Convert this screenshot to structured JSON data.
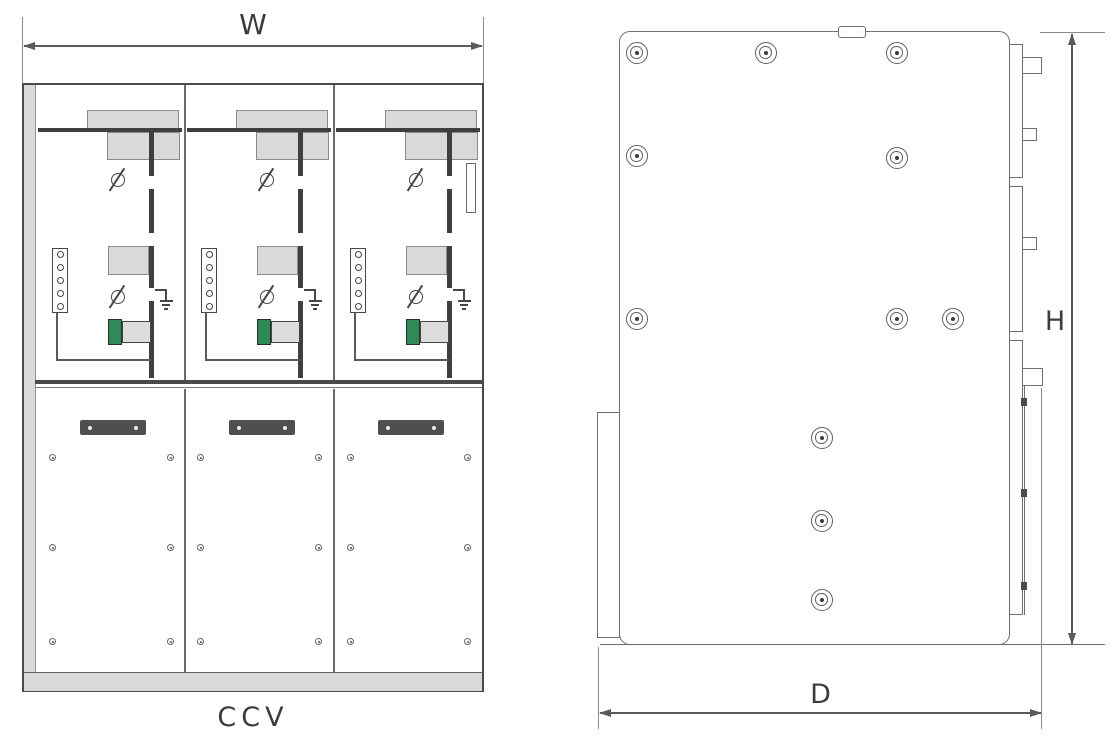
{
  "front_view": {
    "dimension_width_label": "W",
    "caption": "CCV"
  },
  "side_view": {
    "dimension_height_label": "H",
    "dimension_depth_label": "D"
  },
  "colors": {
    "line_dark": "#474747",
    "line_medium": "#6f6f6f",
    "panel_fill_gray": "#d9d9d9",
    "handle_gray": "#4f4f4f",
    "indicator_green": "#2e8b57",
    "background": "#ffffff"
  }
}
